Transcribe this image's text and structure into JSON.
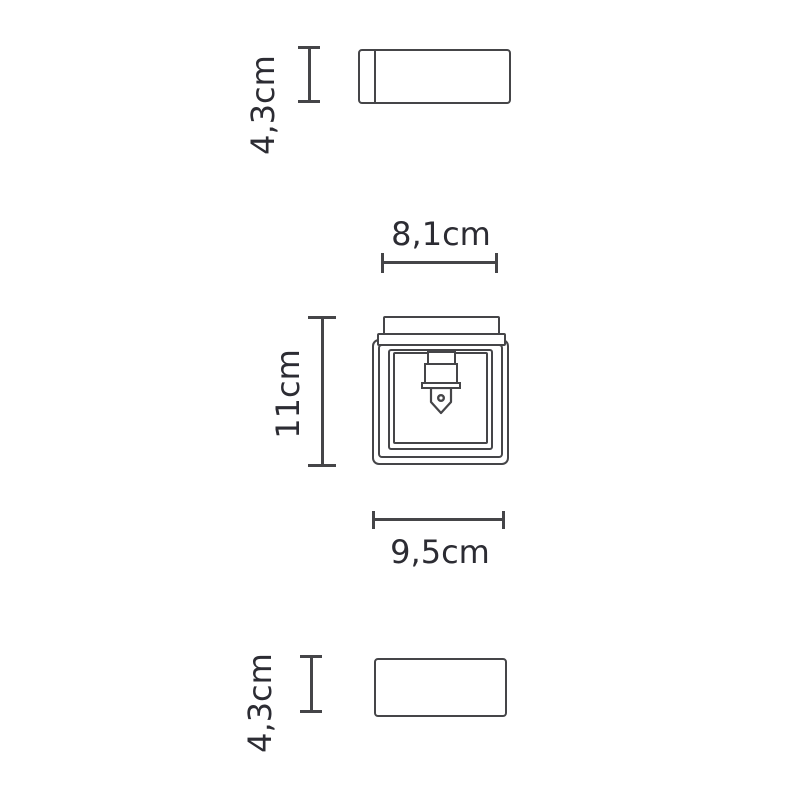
{
  "drawing": {
    "background_color": "#ffffff",
    "stroke_color": "#454548",
    "label_color": "#2c2c33",
    "unit": "cm",
    "dimensions": {
      "top_view_height": "4,3cm",
      "canopy_width": "8,1cm",
      "body_height": "11cm",
      "body_width": "9,5cm",
      "bottom_view_height": "4,3cm"
    }
  }
}
